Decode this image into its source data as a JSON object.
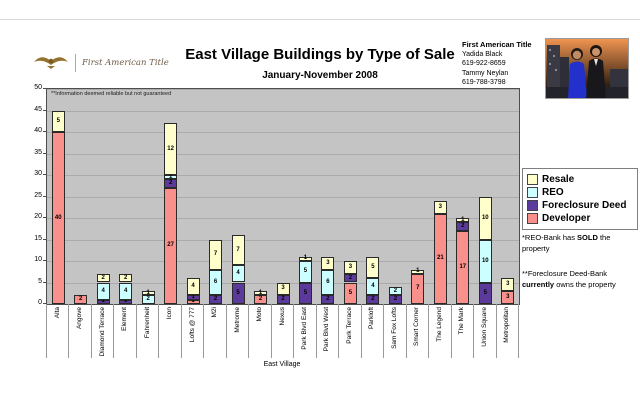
{
  "header": {
    "logo_text": "First American Title",
    "title": "East Village Buildings by Type of Sale",
    "subtitle": "January-November 2008",
    "contact": {
      "company": "First American Title",
      "lines": [
        "Yadida Black",
        "619-922-8659",
        "Tammy Neylan",
        "619-788-3798"
      ]
    }
  },
  "icons": {
    "logo": "eagle-icon",
    "photo": "agents-photo"
  },
  "chart_data": {
    "type": "bar",
    "stacked": true,
    "title": "East Village Buildings by Type of Sale",
    "subtitle": "January-November 2008",
    "xlabel": "East Village",
    "ylabel": "",
    "ylim": [
      0,
      50
    ],
    "ytick_step": 5,
    "grid": true,
    "plot_bg": "#c4c4c4",
    "note": "**Information deemed reliable but not guaranteed",
    "legend_position": "right",
    "categories": [
      "Alta",
      "Angove",
      "Diamond Terrace",
      "Element",
      "Fahrenheit",
      "Icon",
      "Lofts @ 777",
      "M2i",
      "Metrome",
      "Moto",
      "Nexus",
      "Park Blvd East",
      "Park Blvd West",
      "Park Terrace",
      "Parkloft",
      "Sam Fox Lofts",
      "Smart Corner",
      "The Legend",
      "The Mark",
      "Union Square",
      "Metropolitan"
    ],
    "series": [
      {
        "name": "Developer",
        "color": "#f9908c",
        "values": [
          40,
          2,
          0,
          0,
          0,
          27,
          1,
          0,
          0,
          2,
          0,
          0,
          0,
          5,
          0,
          0,
          7,
          21,
          17,
          0,
          3
        ]
      },
      {
        "name": "Foreclosure Deed",
        "color": "#5b3a9b",
        "values": [
          0,
          0,
          1,
          1,
          0,
          2,
          1,
          2,
          5,
          0,
          2,
          5,
          2,
          2,
          2,
          2,
          0,
          0,
          2,
          5,
          0
        ]
      },
      {
        "name": "REO",
        "color": "#ccffff",
        "values": [
          0,
          0,
          4,
          4,
          2,
          1,
          0,
          6,
          4,
          0,
          0,
          5,
          6,
          0,
          4,
          2,
          0,
          0,
          0,
          10,
          0
        ]
      },
      {
        "name": "Resale",
        "color": "#ffffcc",
        "values": [
          5,
          0,
          2,
          2,
          1,
          12,
          4,
          7,
          7,
          1,
          3,
          1,
          3,
          3,
          5,
          0,
          1,
          3,
          1,
          10,
          3
        ]
      }
    ],
    "totals": [
      45,
      2,
      7,
      7,
      3,
      42,
      6,
      15,
      16,
      3,
      5,
      11,
      11,
      10,
      11,
      4,
      8,
      24,
      20,
      25,
      6
    ]
  },
  "legend": {
    "items": [
      {
        "label": "Resale",
        "color": "#ffffcc"
      },
      {
        "label": "REO",
        "color": "#ccffff"
      },
      {
        "label": "Foreclosure Deed",
        "color": "#5b3a9b"
      },
      {
        "label": "Developer",
        "color": "#f9908c"
      }
    ]
  },
  "side_notes": {
    "reo": [
      "*REO-Bank has ",
      "SOLD",
      " the property"
    ],
    "fd": [
      "**Foreclosure Deed-Bank ",
      "currently",
      " owns the property"
    ]
  }
}
